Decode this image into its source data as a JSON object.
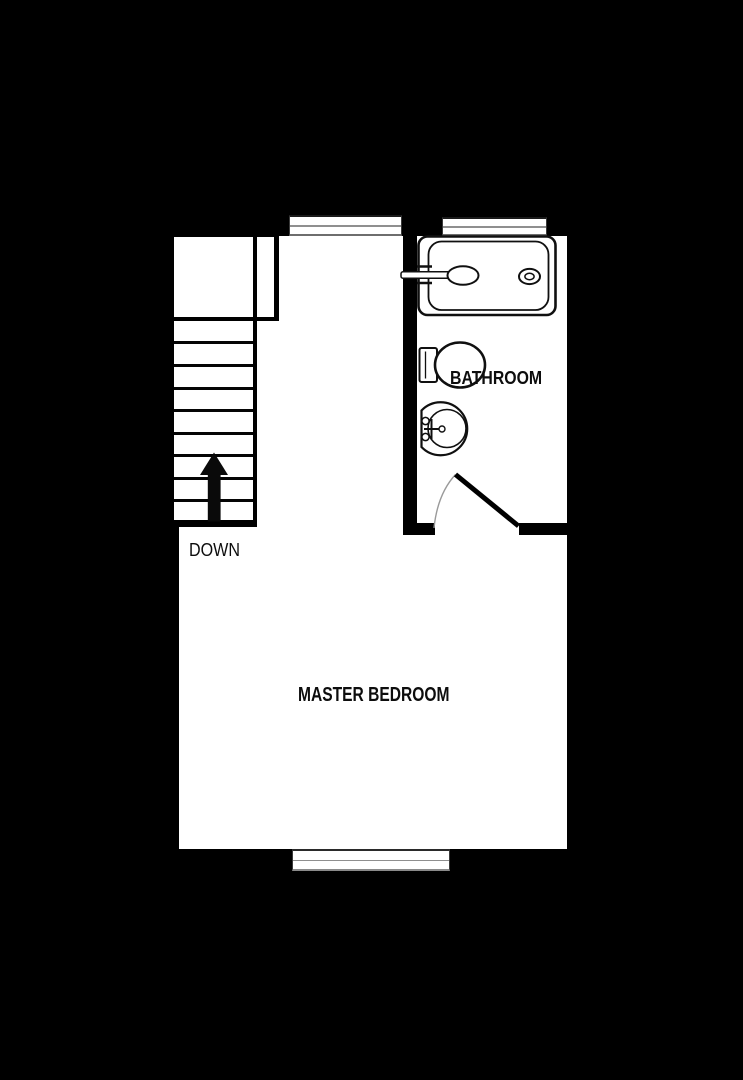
{
  "floor_plan": {
    "title": "upper floor plan",
    "background_color": "#000000",
    "floor_color": "#ffffff",
    "wall_color": "#000000",
    "window_pane_color": "#8f8f8f",
    "label_color": "#0d0d0d",
    "rooms": [
      {
        "label": "MASTER BEDROOM"
      },
      {
        "label": "BATHROOM"
      }
    ],
    "stairs": {
      "label": "DOWN",
      "direction_icon": "up-arrow-icon",
      "tread_count": 9
    },
    "fixtures": [
      "bathtub",
      "tub-faucet",
      "tub-drain",
      "toilet",
      "sink",
      "door-swing"
    ],
    "window_count": 3
  },
  "labels": {
    "master_bedroom": "MASTER BEDROOM",
    "bathroom": "BATHROOM",
    "down": "DOWN"
  }
}
